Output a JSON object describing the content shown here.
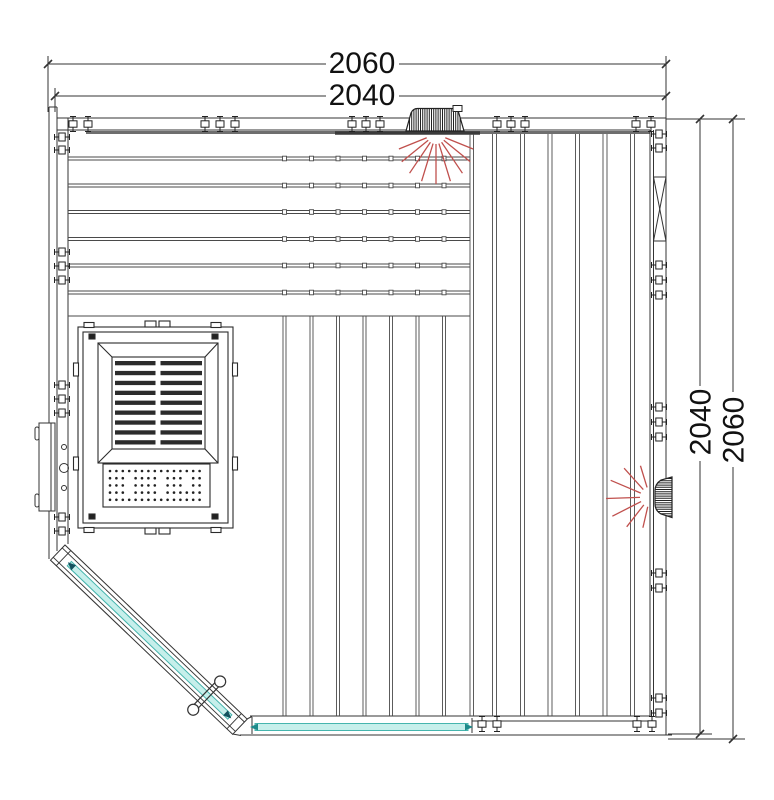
{
  "dimensions": {
    "top_overall": "2060",
    "top_panel": "2040",
    "right_panel": "2040",
    "right_overall": "2060"
  },
  "colors": {
    "line": "#333333",
    "board_line": "#4a4a4a",
    "thick_edge": "#6e6e6e",
    "glass_fill": "#c6efeb",
    "glass_stroke": "#45b5ae",
    "glass_arrow": "#1d8a8a",
    "door_arrow": "#14525e",
    "ray_red": "#c0504d",
    "hatch_dark": "#222222",
    "dim_text": "#111111"
  },
  "drawing": {
    "bench": {
      "x1": 68,
      "x2": 470,
      "gaps": [
        157,
        184,
        210.5,
        237.5,
        264,
        291
      ],
      "ticks": [
        283,
        310,
        336.5,
        363,
        389.5,
        416,
        442.5
      ],
      "bottom": 316
    },
    "boards_center": {
      "xs": [
        283,
        310,
        336.5,
        363,
        389.5,
        416,
        442.5
      ],
      "pair": 3,
      "y1": 316,
      "y2": 716
    },
    "boards_right": {
      "xs": [
        492.5,
        520.5,
        548,
        575.5,
        603,
        630.5
      ],
      "pair": 4,
      "y1": 134,
      "y2": 716
    },
    "clips": {
      "top": {
        "y": 124,
        "xs": [
          73,
          88,
          205,
          220,
          235,
          352,
          366,
          380,
          497,
          511,
          525,
          636,
          651
        ]
      },
      "bottom": {
        "y": 724,
        "xs": [
          482,
          497,
          637,
          652
        ]
      },
      "left": {
        "x": 62,
        "ys": [
          137,
          150,
          252,
          266,
          280,
          385,
          399,
          413,
          517,
          531
        ]
      },
      "right": {
        "x": 659,
        "ys": [
          134,
          148,
          265,
          280,
          295,
          407,
          422,
          437,
          573,
          588,
          698,
          713
        ]
      }
    },
    "rays_top": {
      "cx": 436,
      "cy": 134,
      "angles": [
        22,
        39,
        56,
        73,
        90,
        107,
        124,
        141,
        158
      ],
      "r1": 10,
      "base": 34,
      "amp": 16,
      "axis": 0
    },
    "rays_right": {
      "cx": 650,
      "cy": 497,
      "angles": [
        103,
        128,
        153,
        178,
        203,
        228,
        253
      ],
      "r1": 10,
      "base": 28,
      "amp": 16,
      "axis": 90
    },
    "grille": {
      "y0": 361,
      "rows": 9,
      "step": 9.9,
      "h": 4.3,
      "col1x": 115,
      "col1w": 40.5,
      "col2x": 160.5,
      "col2w": 41.5
    },
    "perf": {
      "x0": 110,
      "y0": 471,
      "cols": 15,
      "rows": 5,
      "dx": 6.4,
      "dy": 7.2,
      "r": 1.3,
      "skip": [
        [
          1,
          3
        ],
        [
          2,
          3
        ],
        [
          3,
          3
        ],
        [
          1,
          8
        ],
        [
          2,
          8
        ],
        [
          3,
          8
        ],
        [
          1,
          12
        ],
        [
          2,
          12
        ]
      ]
    },
    "hatch_top_vent": {
      "x1": 409.5,
      "x2": 461,
      "step": 2.2,
      "y1": 108,
      "y2": 132
    },
    "hatch_right_vent": {
      "y1": 478.5,
      "y2": 516,
      "step": 2.2,
      "x1": 655.5,
      "x2": 671.5
    }
  }
}
